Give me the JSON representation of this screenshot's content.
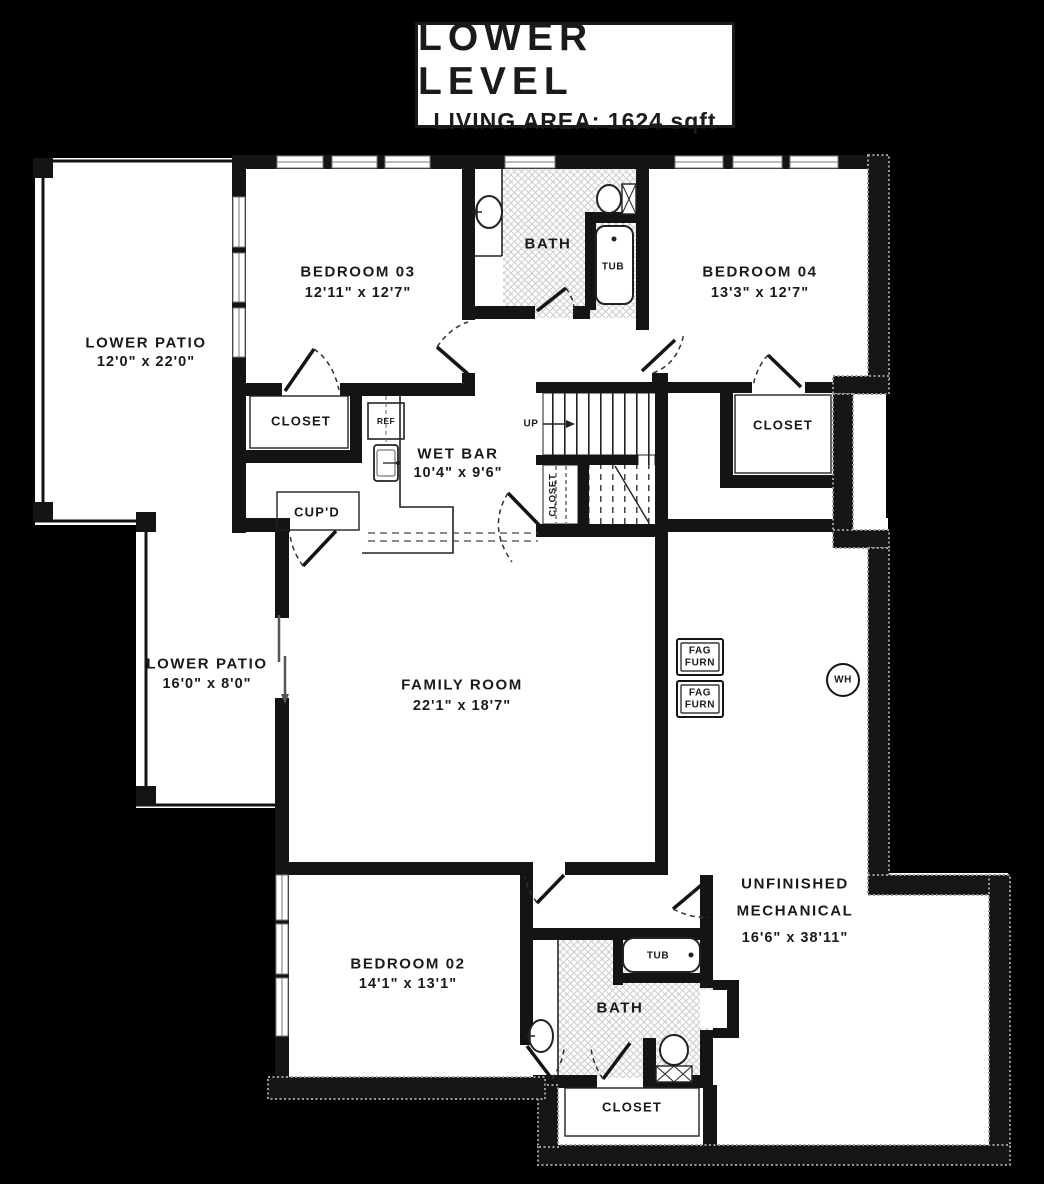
{
  "title_block": {
    "title": "LOWER LEVEL",
    "subtitle": "LIVING AREA: 1624 sqft"
  },
  "labels": {
    "lower_patio_1": {
      "name": "LOWER PATIO",
      "dims": "12'0\" x 22'0\""
    },
    "bedroom_03": {
      "name": "BEDROOM 03",
      "dims": "12'11\" x 12'7\""
    },
    "bath_upper": {
      "name": "BATH"
    },
    "tub_upper": {
      "name": "TUB"
    },
    "bedroom_04": {
      "name": "BEDROOM 04",
      "dims": "13'3\" x 12'7\""
    },
    "closet_bedroom_03": {
      "name": "CLOSET"
    },
    "ref": {
      "name": "REF"
    },
    "wet_bar": {
      "name": "WET BAR",
      "dims": "10'4\" x 9'6\""
    },
    "stairs": {
      "up": "UP"
    },
    "stair_closet": {
      "name": "CLOSET"
    },
    "closet_bedroom_04": {
      "name": "CLOSET"
    },
    "cupboard": {
      "name": "CUP'D"
    },
    "lower_patio_2": {
      "name": "LOWER PATIO",
      "dims": "16'0\" x 8'0\""
    },
    "family_room": {
      "name": "FAMILY ROOM",
      "dims": "22'1\" x 18'7\""
    },
    "furnace_1": {
      "line1": "FAG",
      "line2": "FURN"
    },
    "furnace_2": {
      "line1": "FAG",
      "line2": "FURN"
    },
    "water_heater": {
      "name": "WH"
    },
    "bedroom_02": {
      "name": "BEDROOM 02",
      "dims": "14'1\" x 13'1\""
    },
    "tub_lower": {
      "name": "TUB"
    },
    "bath_lower": {
      "name": "BATH"
    },
    "closet_lower": {
      "name": "CLOSET"
    },
    "unfinished_mechanical": {
      "line1": "UNFINISHED",
      "line2": "MECHANICAL",
      "dims": "16'6\" x 38'11\""
    }
  },
  "colors": {
    "background": "#000000",
    "walls": "#141414",
    "floor": "#ffffff",
    "bath_texture": "#cccccc",
    "foundation_stipple": "#9a9a9a"
  }
}
